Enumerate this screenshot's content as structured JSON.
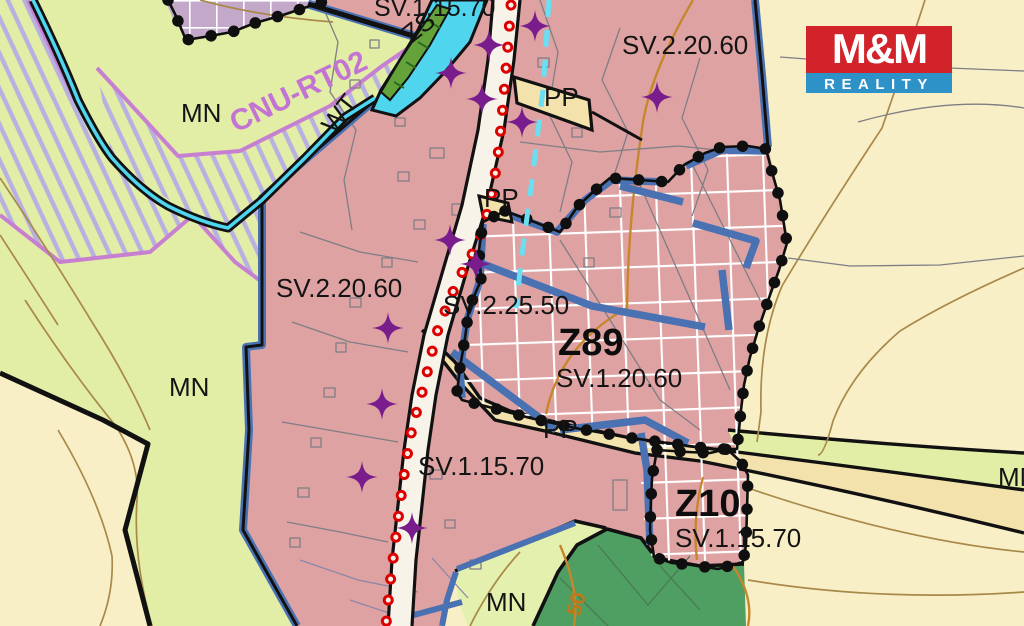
{
  "map": {
    "labels": [
      {
        "id": "sv-top",
        "text": "SV.1.15.70"
      },
      {
        "id": "zs",
        "text": "ZS"
      },
      {
        "id": "sv-northeast",
        "text": "SV.2.20.60"
      },
      {
        "id": "mn-northwest",
        "text": "MN"
      },
      {
        "id": "cnu",
        "text": "CNU-RT02"
      },
      {
        "id": "wt",
        "text": "WT"
      },
      {
        "id": "pp-a",
        "text": "PP"
      },
      {
        "id": "pp-b",
        "text": "PP"
      },
      {
        "id": "sv-west",
        "text": "SV.2.20.60"
      },
      {
        "id": "sv-center",
        "text": "SV.2.25.50"
      },
      {
        "id": "z89",
        "text": "Z89"
      },
      {
        "id": "z89-code",
        "text": "SV.1.20.60"
      },
      {
        "id": "pp-c",
        "text": "PP"
      },
      {
        "id": "sv-south",
        "text": "SV.1.15.70"
      },
      {
        "id": "z10",
        "text": "Z10"
      },
      {
        "id": "z10-code",
        "text": "SV.1.15.70"
      },
      {
        "id": "mn-west",
        "text": "MN"
      },
      {
        "id": "mn-south",
        "text": "MN"
      },
      {
        "id": "mn-east",
        "text": "MN"
      },
      {
        "id": "contour-50",
        "text": "50"
      }
    ],
    "colors": {
      "residential_pink": "#dfa2a2",
      "meadow_green": "#e2eda6",
      "field_cream": "#f9efc6",
      "forest_green": "#4f9e62",
      "water_cyan": "#4fd5ee",
      "reserve_mauve": "#c3a8c9",
      "boundary_blue": "#4a72b3",
      "red_chain": "#dc0000",
      "symbol_purple": "#7a1d8c",
      "cnu_violet": "#c77fd2"
    }
  },
  "logo": {
    "title": "M&M",
    "subtitle": "REALITY",
    "title_bg": "#d2232a",
    "subtitle_bg": "#2d92c8"
  }
}
